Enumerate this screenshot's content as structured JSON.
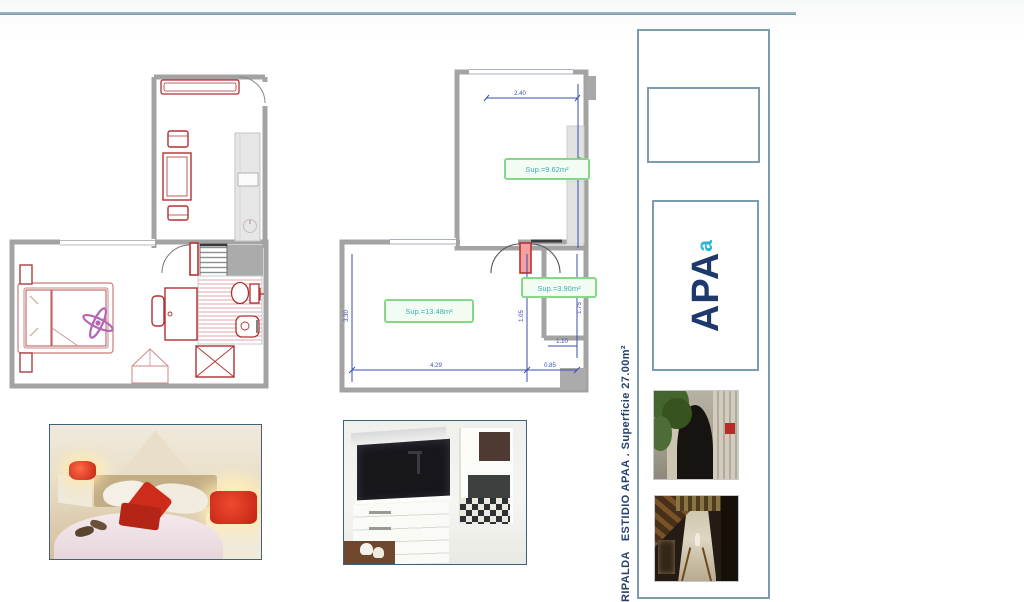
{
  "sidebar": {
    "vertical_title": "RIPALDA   ESTIDIO APAA . Superficie 27.00m²",
    "logo": {
      "main": "APA",
      "accent": "a"
    },
    "photo_names": [
      "building-entrance-arch",
      "covered-passage"
    ]
  },
  "plan_dimensioned": {
    "area_labels": [
      {
        "text": "Sup.=9.62m²"
      },
      {
        "text": "Sup.=13.48m²"
      },
      {
        "text": "Sup.=3.90m²"
      }
    ],
    "dimensions": {
      "upper_width": "2.40",
      "upper_height": "3.87",
      "main_height": "3.30",
      "door_column": "1.05",
      "side_height": "1.75",
      "side_notch": "1.10",
      "bottom_main": "4.29",
      "bottom_side": "0.85"
    }
  },
  "colors": {
    "rule": "#7e98a6",
    "sidebar_border": "#7d9cb0",
    "title_navy": "#27406e",
    "logo_navy": "#1e3a6d",
    "logo_teal": "#2ab5d8",
    "wall_gray": "#a3a3a3",
    "furniture_red": "#b03030",
    "fan_purple": "#b465b5",
    "dimension_blue": "#3a4db0",
    "area_label_green": "#86d886",
    "area_label_text": "#3aaeb4"
  }
}
